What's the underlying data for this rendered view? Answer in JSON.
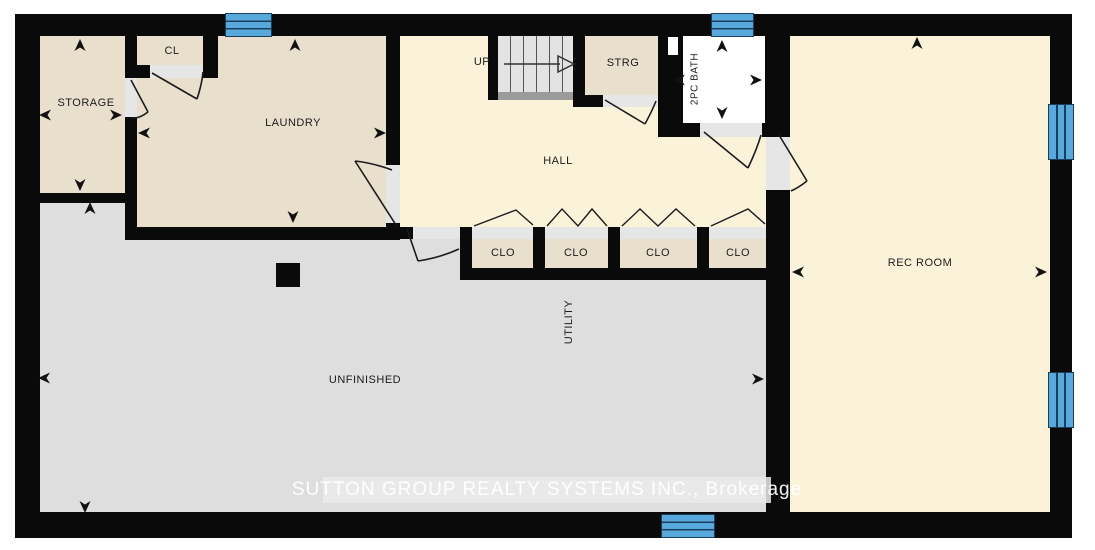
{
  "rooms": {
    "storage": "STORAGE",
    "cl": "CL",
    "laundry": "LAUNDRY",
    "up": "UP",
    "strg": "STRG",
    "bath": "2PC BATH",
    "hall": "HALL",
    "clo": "CLO",
    "utility": "UTILITY",
    "unfinished": "UNFINISHED",
    "rec_room": "REC ROOM"
  },
  "watermark": "SUTTON GROUP REALTY SYSTEMS INC., Brokerage",
  "colors": {
    "wall": "#0a0a0a",
    "room_beige": "#e8e0cd",
    "room_cream": "#faf3da",
    "room_gray": "#dedede",
    "bath_white": "#ffffff",
    "window_blue": "#57a9dc",
    "window_line": "#1c3c5c",
    "stairs": "#e3e3e3",
    "door_sill": "#e6e6e6",
    "label": "#1c1c1c"
  }
}
